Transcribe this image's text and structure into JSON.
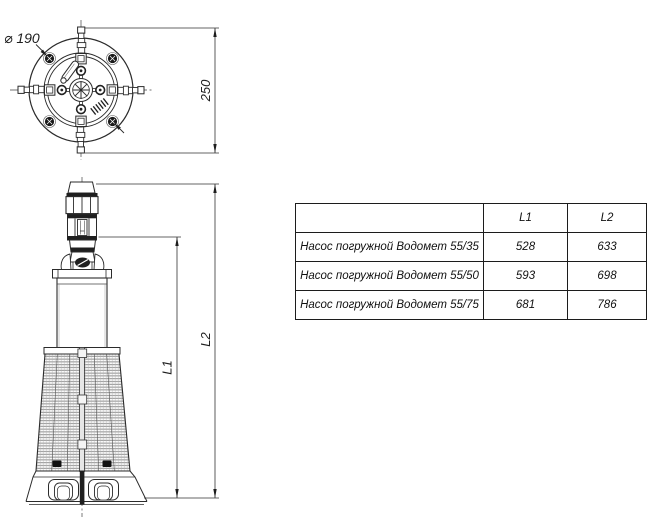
{
  "drawing": {
    "top_view": {
      "diameter_label": "⌀ 190",
      "vertical_dim": "250"
    },
    "side_view": {
      "l1_label": "L1",
      "l2_label": "L2"
    },
    "line_color": "#2b2b2b"
  },
  "table": {
    "headers": [
      "",
      "L1",
      "L2"
    ],
    "rows": [
      {
        "name": "Насос погружной Водомет 55/35",
        "l1": "528",
        "l2": "633"
      },
      {
        "name": "Насос погружной Водомет 55/50",
        "l1": "593",
        "l2": "698"
      },
      {
        "name": "Насос погружной Водомет 55/75",
        "l1": "681",
        "l2": "786"
      }
    ]
  }
}
